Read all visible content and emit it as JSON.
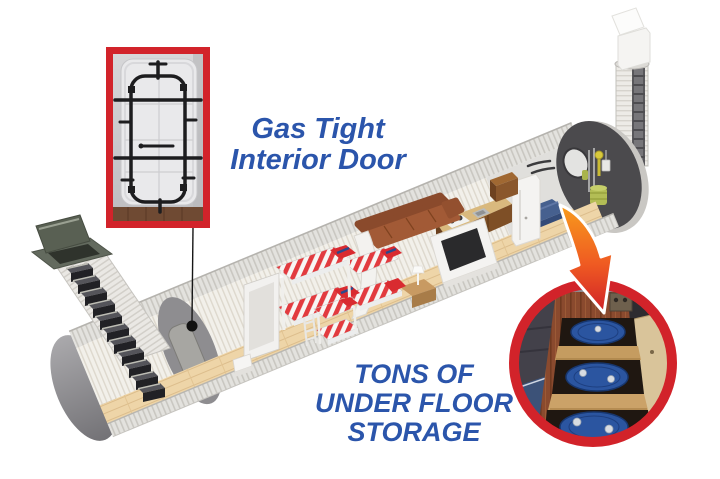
{
  "image": {
    "subject": "cutaway illustration of cylindrical underground bunker shelter with two entrances"
  },
  "callouts": {
    "door": {
      "line1": "Gas Tight",
      "line2": "Interior Door",
      "photo": "gas-tight-door-photo"
    },
    "storage": {
      "line1": "TONS OF",
      "line2": "UNDER FLOOR",
      "line3": "STORAGE",
      "photo": "under-floor-storage-photo"
    }
  },
  "colors": {
    "label_blue": "#2b55ab",
    "accent_red": "#d2232a",
    "arrow_orange": "#f89c1c",
    "arrow_red": "#cf2028",
    "shell_gray": "#e6e5e1",
    "interior_wall": "#f2f0ea",
    "floor_wood": "#eed5a8",
    "bulkhead_gray": "#8e8d90",
    "endcap_charcoal": "#4b4a4d",
    "bed_stripe_red": "#e23b3f",
    "couch_brown": "#9a5334",
    "barrel_blue": "#2b55a0",
    "storage_floor_wood": "#8a4a2e"
  }
}
